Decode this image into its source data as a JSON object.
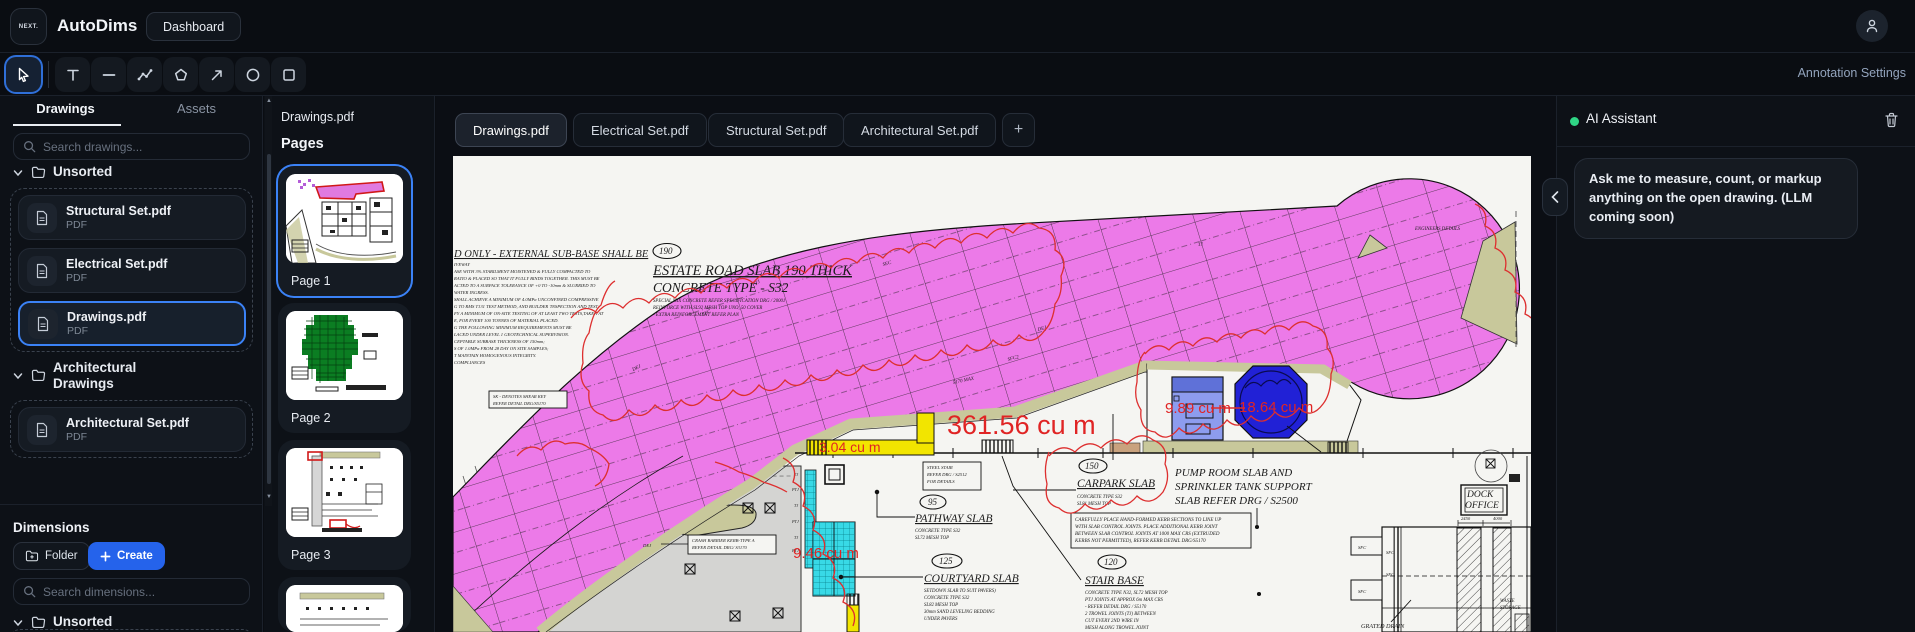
{
  "topbar": {
    "logo": "NEXT.",
    "app_title": "AutoDims",
    "dashboard_button": "Dashboard"
  },
  "toolbar": {
    "tools": [
      "cursor",
      "text",
      "line",
      "polyline",
      "polygon",
      "arrow",
      "ellipse",
      "rectangle"
    ],
    "annotation_settings_label": "Annotation Settings"
  },
  "sidebar": {
    "tabs": [
      {
        "label": "Drawings"
      },
      {
        "label": "Assets"
      }
    ],
    "search_placeholder": "Search drawings...",
    "groups": [
      {
        "label": "Unsorted",
        "items": [
          {
            "title": "Structural Set.pdf",
            "type": "PDF"
          },
          {
            "title": "Electrical Set.pdf",
            "type": "PDF"
          },
          {
            "title": "Drawings.pdf",
            "type": "PDF"
          }
        ]
      },
      {
        "label": "Architectural Drawings",
        "items": [
          {
            "title": "Architectural Set.pdf",
            "type": "PDF"
          }
        ]
      }
    ],
    "dimensions": {
      "heading": "Dimensions",
      "folder_button": "Folder",
      "create_button": "Create",
      "search_placeholder": "Search dimensions...",
      "group_label": "Unsorted"
    }
  },
  "pages_panel": {
    "doc_title": "Drawings.pdf",
    "heading": "Pages",
    "pages": [
      {
        "label": "Page 1"
      },
      {
        "label": "Page 2"
      },
      {
        "label": "Page 3"
      },
      {
        "label": "Page 4"
      }
    ]
  },
  "main": {
    "tabs": [
      {
        "label": "Drawings.pdf"
      },
      {
        "label": "Electrical Set.pdf"
      },
      {
        "label": "Structural Set.pdf"
      },
      {
        "label": "Architectural Set.pdf"
      }
    ],
    "add_tab_label": "+"
  },
  "ai_panel": {
    "title": "AI Assistant",
    "status_color": "#2fd585",
    "message": "Ask me to measure, count, or markup anything on the open drawing. (LLM coming soon)"
  },
  "canvas": {
    "notes_heading": "D ONLY - EXTERNAL SUB-BASE SHALL BE",
    "notes_lines": [
      "IVEWAY",
      "ASE WITH 3% STABILMENT MOISTENED & FULLY COMPACTED TO",
      "RATIO &  PLACED SO THAT IT FULLY BINDS TOGETHER. THIS MUST BE",
      "ACTED TO A SURFACE TOLERANCE OF +0 TO -10mm & SLURRIED TO",
      "WATER INGRESS.",
      "SHALL ACHIEVE A MINIMUM OF 4.0MPa UNCONFINED COMPRESSIVE",
      "G TO RMS T131 TEST METHOD, AND BUILDER 'INSPECTION AND TEST",
      "FY A MINIMUM OF ON-SITE TESTING OF AT LEAST TWO TESTS,TAKEN AT",
      "E, FOR EVERY 100 TONNES OF MATERIAL PLACED.",
      "G THE FOLLOWING MINIMUM REQUIREMENTS MUST BE",
      "LACED UNDER LEVEL 1 GEOTECHNICAL SUPERVISION.",
      "CEPTABLE SUBBASE THICKNESS OF 150mm;",
      "S OF 1.0MPa FROM 28 DAY ON SITE SAMPLES;",
      "T MAINTAIN HOMOGENOUS INTEGRITY.",
      "COMPLIANCES"
    ],
    "sk_note": [
      "SK - DENOTES SHEAR KEY",
      "REFER DETAIL DRG/S5170"
    ],
    "estate": {
      "badge": "190",
      "title": "ESTATE ROAD SLAB 190 THICK",
      "subtitle": "CONCRETE TYPE  -  S32",
      "notes": [
        "SPECIAL MIX CONCRETE REFER SPECIFICATION DRG / 20001",
        "REINFORCE WITH SL92 MESH TOP UNO, 50 COVER",
        "- EXTRA REINFORCEMENT REFER PLAN"
      ]
    },
    "carpark": {
      "badge": "150",
      "title": "CARPARK SLAB",
      "notes": [
        "CONCRETE TYPE S32",
        "SL81 MESH TOP"
      ]
    },
    "pathway": {
      "badge": "95",
      "title": "PATHWAY SLAB",
      "notes": [
        "CONCRETE TYPE S32",
        "SL72 MESH TOP"
      ]
    },
    "courtyard": {
      "badge": "125",
      "title": "COURTYARD SLAB",
      "notes": [
        "SETDOWN SLAB TO SUIT PAVERS)",
        "CONCRETE TYPE S32",
        "SL82 MESH TOP",
        "30mm SAND LEVELING BEDDING",
        "UNDER PAVERS"
      ]
    },
    "stair_base": {
      "badge": "120",
      "title": "STAIR BASE",
      "notes": [
        "CONCRETE TYPE N32, SL72 MESH TOP",
        "PTJ JOINTS AT APPROX 6m MAX  CRS",
        "- REFER DETAIL DRG / S5170",
        "2 TROWEL JOINTS (TJ) BETWEEN",
        "CUT EVERY 2ND WIRE IN",
        "MESH  ALONG TROWEL JOINT"
      ]
    },
    "pump_label": [
      "PUMP ROOM SLAB AND",
      "SPRINKLER TANK SUPPORT",
      "SLAB REFER DRG / S2500"
    ],
    "steel_stair_note": [
      "STEEL STAIR",
      "REFER DRG / S2512",
      "FOR DETAILS"
    ],
    "kerb_note": [
      "CAREFULLY PLACE HAND-FORMED KERB SECTIONS TO LINE UP",
      "WITH SLAB CONTROL JOINTS. PLACE ADDITIONAL KERB JOINT",
      "BETWEEN SLAB CONTROL JOINTS AT 1000 MAX CRS (EXTRUDED",
      "KERBS NOT PERMITTED), REFER KERB DETAIL DRG/S5170"
    ],
    "crash_note": [
      "CRASH BARRIER KERB-TYPE A",
      "REFER DETAIL DRG/ S3170"
    ],
    "dock_office": [
      "DOCK",
      "OFFICE"
    ],
    "grated_drain": "GRATED DRAIN",
    "engineers_details": "ENGINEERS DETAILS",
    "waste": [
      "WASTE",
      "STORAGE"
    ],
    "dims": [
      "2450",
      "4000"
    ],
    "road_marks": [
      "SFC",
      "DEJ",
      "PTJ",
      "TJ",
      "SFC2",
      "SEC",
      "5170 MAX",
      "DEJ"
    ],
    "tj_column": [
      "TJ",
      "PTJ",
      "TJ",
      "PTJ",
      "TJ",
      "PTJ"
    ],
    "sfc_marks": [
      "SFC",
      "SFC",
      "SFC",
      "SFC"
    ],
    "measurements": {
      "road": "361.56 cu m",
      "pump": "9.89 cu m",
      "tank": "18.64 cu m",
      "courtyard": "9.46 cu m",
      "strip": "3.04 cu m"
    },
    "colors": {
      "pink": "#ec7ae8",
      "olive": "#c8c89b",
      "cyan": "#38d9e6",
      "yellow": "#f2e500",
      "tank_blue": "#2121d6",
      "pump_blue": "#8d9cee",
      "annotation_red": "#dd2f2f"
    }
  }
}
